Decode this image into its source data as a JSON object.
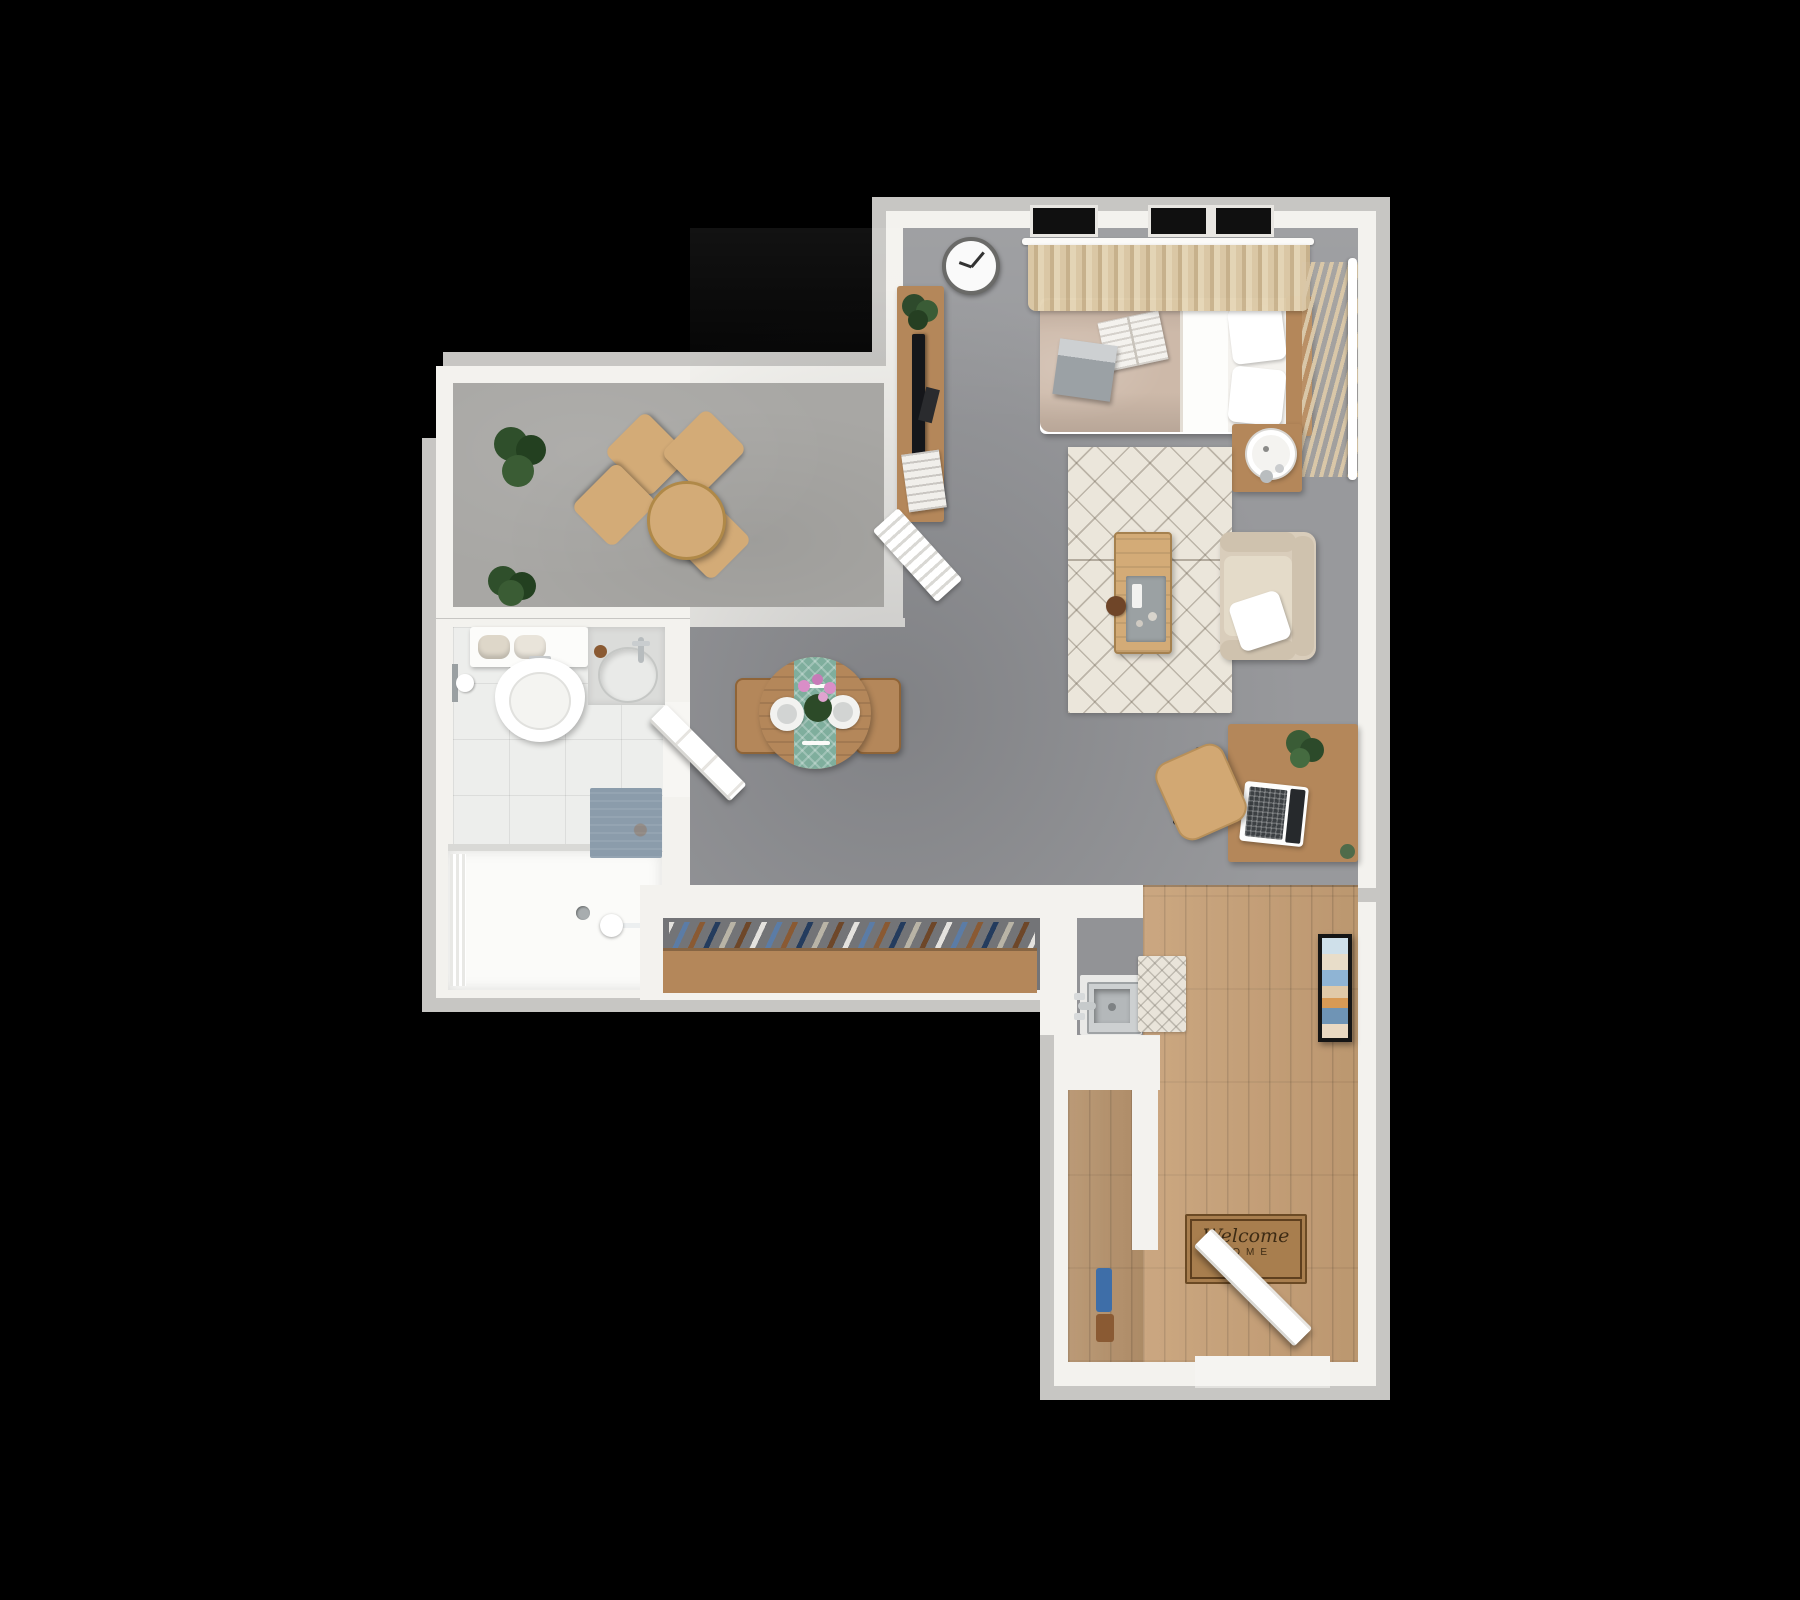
{
  "scene": {
    "description": "3D top-down rendered floor plan of a studio apartment on black background",
    "style": "photoreal architectural render, bird's-eye view"
  },
  "mat": {
    "line1": "Welcome",
    "line2": "HOME"
  },
  "rooms": [
    {
      "name": "bedroom-living-room",
      "floor": "gray carpet"
    },
    {
      "name": "balcony",
      "floor": "gray stone"
    },
    {
      "name": "bathroom",
      "floor": "light tile"
    },
    {
      "name": "hallway-dining",
      "floor": "gray carpet"
    },
    {
      "name": "closet",
      "floor": "gray with wood rail"
    },
    {
      "name": "entry-kitchenette",
      "floor": "wood planks"
    }
  ],
  "furniture": [
    "wall-clock",
    "curtains",
    "window",
    "bed",
    "pillows",
    "magazine",
    "tissue-box",
    "vertical-blinds",
    "nightstand",
    "table-lamp",
    "tv-console",
    "television",
    "console-plant",
    "magazine-stack",
    "drying-rack",
    "area-rug",
    "coffee-table",
    "tray",
    "armchair",
    "throw-pillow",
    "desk",
    "laptop",
    "desk-plant",
    "office-chair",
    "balcony-table",
    "balcony-chairs",
    "potted-plants",
    "toilet",
    "towel-shelf",
    "toilet-paper-holder",
    "bathroom-vanity",
    "sink",
    "bath-mat",
    "bathtub",
    "shower-head",
    "bathroom-door",
    "dining-table",
    "table-runner",
    "dinner-plates",
    "cutlery",
    "flower-vase",
    "dining-chairs",
    "closet-clothes",
    "closet-rod",
    "kitchen-sink",
    "faucet",
    "entry-rug",
    "welcome-mat",
    "entry-door",
    "wall-art-frame",
    "storage-closet",
    "storage-items"
  ],
  "colors": {
    "wall_outer": "#c7c6c3",
    "wall_inner": "#f3f2ee",
    "carpet": "#98999c",
    "stone": "#a8a7a4",
    "tile": "#edeeec",
    "wood_floor": "#c7a076",
    "wood": "#b4875a",
    "wood_light": "#d3ab77",
    "closet_back": "#737477",
    "teal": "#7fae9d",
    "duvet": "#cdb9a9",
    "beige_chair": "#d9cdbb",
    "rug": "#ebe6db",
    "mat": "#a87e4e",
    "blind": "#d9c7a8",
    "bathmat": "#8b9cab"
  }
}
